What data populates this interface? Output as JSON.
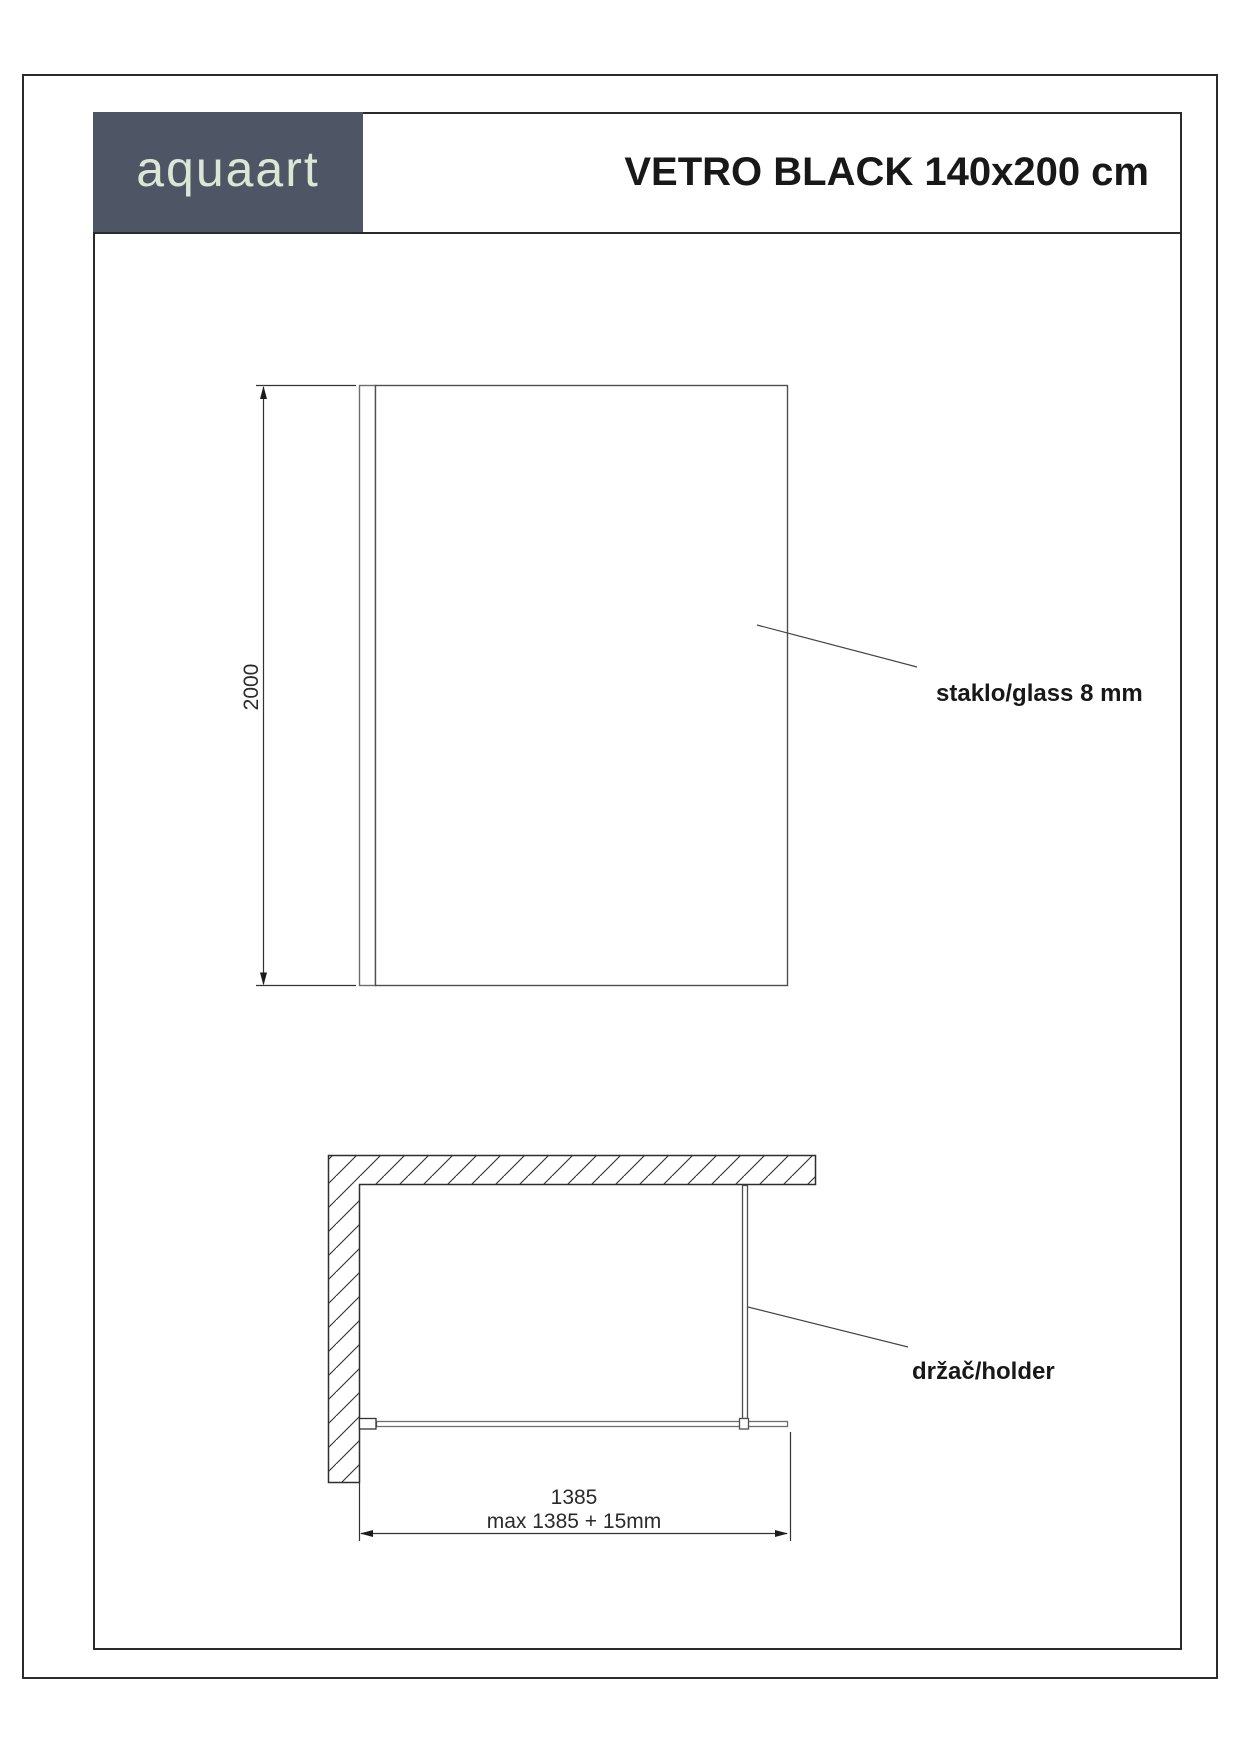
{
  "header": {
    "logo_text": "aquaart",
    "title": "VETRO BLACK 140x200 cm"
  },
  "front_view": {
    "name": "glass panel elevation",
    "height_dimension": "2000",
    "glass_label": "staklo/glass 8 mm"
  },
  "plan_view": {
    "name": "glass panel top view",
    "width_dimension": "1385",
    "width_dimension_max": "max 1385 + 15mm",
    "holder_label": "držač/holder"
  },
  "colors": {
    "logo_background": "#4e5665",
    "logo_text": "#dce6d5",
    "frame_line": "#2b2b2b",
    "drawing_line": "#4f4f4f",
    "label_text": "#181818"
  }
}
